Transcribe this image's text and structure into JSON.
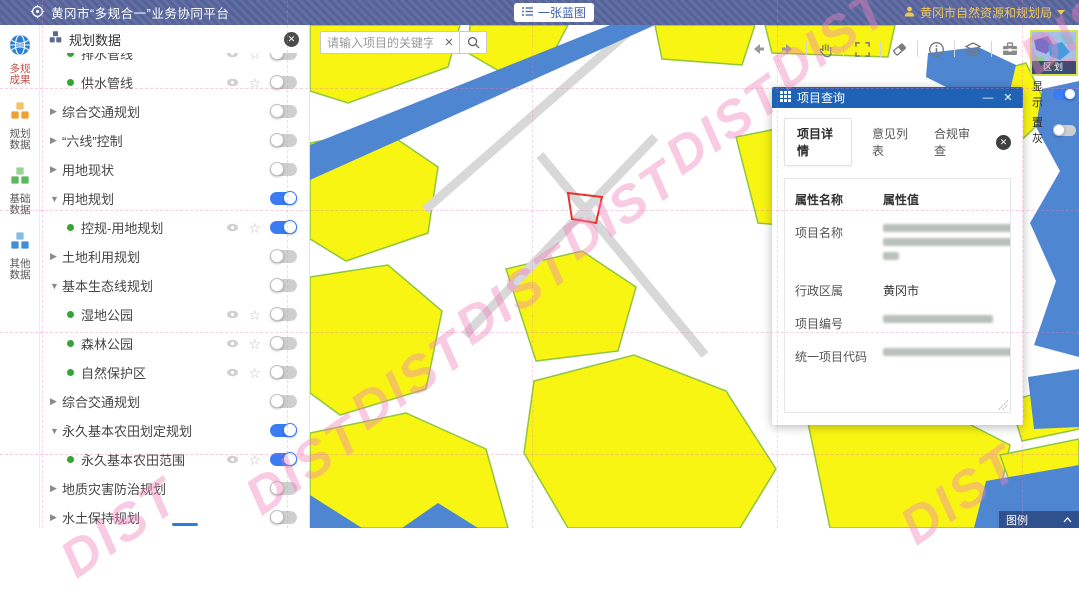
{
  "header": {
    "title": "黄冈市“多规合一”业务协同平台",
    "blueprint_button": "一张蓝图",
    "user_name": "黄冈市自然资源和规划局"
  },
  "sidebar": {
    "items": [
      {
        "label": "多规成果",
        "icon": "globe-icon",
        "active": true
      },
      {
        "label": "规划数据",
        "icon": "cubes-orange-icon",
        "active": false
      },
      {
        "label": "基础数据",
        "icon": "cubes-green-icon",
        "active": false
      },
      {
        "label": "其他数据",
        "icon": "cubes-blue-icon",
        "active": false
      }
    ]
  },
  "layer_panel": {
    "title": "规划数据",
    "items": [
      {
        "type": "leaf",
        "label": "排水管线",
        "on": false,
        "clipped": true
      },
      {
        "type": "leaf",
        "label": "供水管线",
        "on": false
      },
      {
        "type": "group",
        "label": "综合交通规划",
        "expanded": false,
        "on": false
      },
      {
        "type": "group",
        "label": "“六线”控制",
        "expanded": false,
        "on": false
      },
      {
        "type": "group",
        "label": "用地现状",
        "expanded": false,
        "on": false
      },
      {
        "type": "group",
        "label": "用地规划",
        "expanded": true,
        "on": true
      },
      {
        "type": "leaf",
        "label": "控规-用地规划",
        "on": true
      },
      {
        "type": "group",
        "label": "土地利用规划",
        "expanded": false,
        "on": false
      },
      {
        "type": "group",
        "label": "基本生态线规划",
        "expanded": true,
        "on": false
      },
      {
        "type": "leaf",
        "label": "湿地公园",
        "on": false
      },
      {
        "type": "leaf",
        "label": "森林公园",
        "on": false
      },
      {
        "type": "leaf",
        "label": "自然保护区",
        "on": false
      },
      {
        "type": "group",
        "label": "综合交通规划",
        "expanded": false,
        "on": false
      },
      {
        "type": "group",
        "label": "永久基本农田划定规划",
        "expanded": true,
        "on": true
      },
      {
        "type": "leaf",
        "label": "永久基本农田范围",
        "on": true
      },
      {
        "type": "group",
        "label": "地质灾害防治规划",
        "expanded": false,
        "on": false
      },
      {
        "type": "group",
        "label": "水土保持规划",
        "expanded": false,
        "on": false
      }
    ]
  },
  "map": {
    "search_placeholder": "请输入项目的关键字...",
    "toolbar_icons": [
      "back-icon",
      "forward-icon",
      "pan-hand-icon",
      "marquee-select-icon",
      "eraser-icon",
      "info-icon",
      "layers-icon",
      "toolbox-icon"
    ],
    "minimap": {
      "label": "区划",
      "show_label": "显示",
      "show_on": true,
      "gray_label": "置灰",
      "gray_on": false
    },
    "legend_label": "图例",
    "colors": {
      "farmland_yellow": "#f8f513",
      "farmland_border": "#8ec63f",
      "water_blue": "#4f86d2",
      "road_gray": "#d8d8d8",
      "selection_red": "#e8322c"
    }
  },
  "query_panel": {
    "title": "项目查询",
    "tabs": [
      "项目详情",
      "意见列表",
      "合规审查"
    ],
    "active_tab": "项目详情",
    "table": {
      "headers": [
        "属性名称",
        "属性值"
      ],
      "rows": [
        {
          "name": "项目名称",
          "value": "",
          "redacted": true
        },
        {
          "name": "行政区属",
          "value": "黄冈市",
          "redacted": false
        },
        {
          "name": "项目编号",
          "value": "",
          "redacted": true
        },
        {
          "name": "统一项目代码",
          "value": "",
          "redacted": true
        }
      ]
    }
  },
  "watermark": {
    "text": "DIST",
    "color": "#ee82b9"
  }
}
